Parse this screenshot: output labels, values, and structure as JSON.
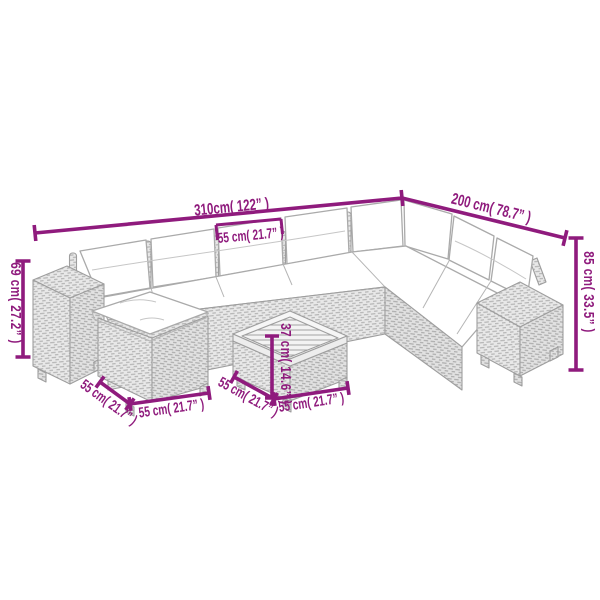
{
  "diagram": {
    "background_color": "#ffffff",
    "dimension_color": "#8F1B7D",
    "sketch_line_color": "#9e9e9e",
    "dimensions": {
      "sofa_total_width": "310cm( 122” )",
      "sofa_right_depth": "200 cm( 78.7” )",
      "seat_section_width": "55 cm( 21.7” )",
      "armrest_height": "69 cm( 27.2” )",
      "backrest_height": "85 cm( 33.5” )",
      "table_height": "37 cm( 14.6” )",
      "ottoman_side_depth": "55 cm( 21.7” )",
      "ottoman_front_width": "55 cm( 21.7” )",
      "table_side_depth": "55 cm( 21.7” )",
      "table_front_width": "55 cm( 21.7” )"
    }
  }
}
